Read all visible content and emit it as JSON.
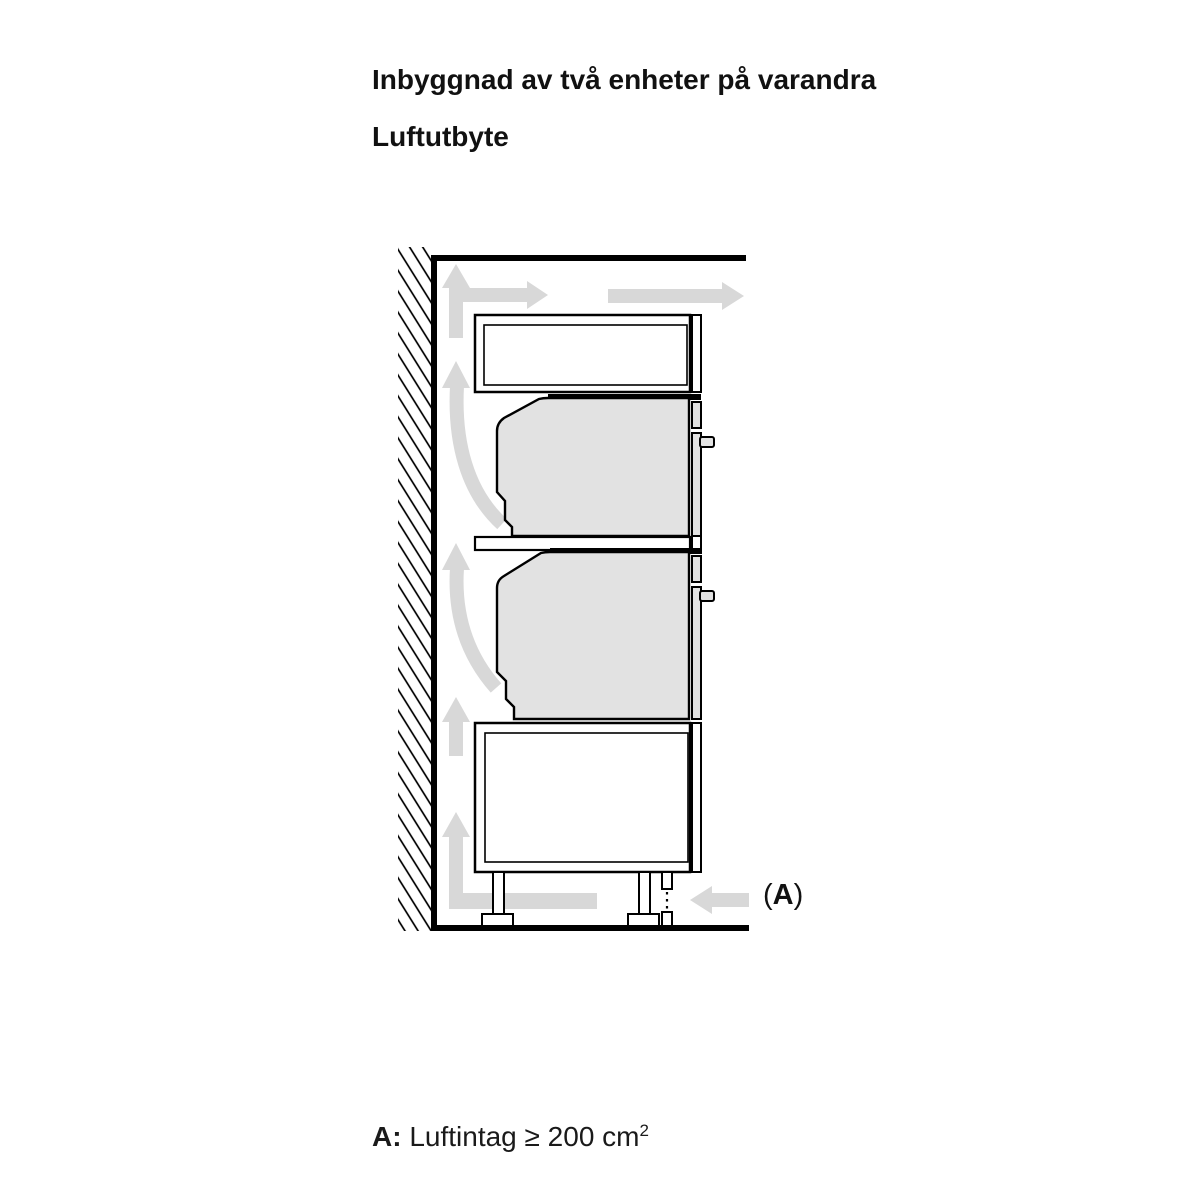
{
  "header": {
    "title": "Inbyggnad av två enheter på varandra",
    "subtitle": "Luftutbyte"
  },
  "diagram": {
    "marker_a": {
      "open": "(",
      "letter": "A",
      "close": ")"
    }
  },
  "legend": {
    "label": "A:",
    "text": " Luftintag ≥ 200 cm",
    "superscript": "2"
  },
  "colors": {
    "arrow": "#d8d8d8",
    "oven": "#e2e2e2",
    "line": "#000000"
  }
}
